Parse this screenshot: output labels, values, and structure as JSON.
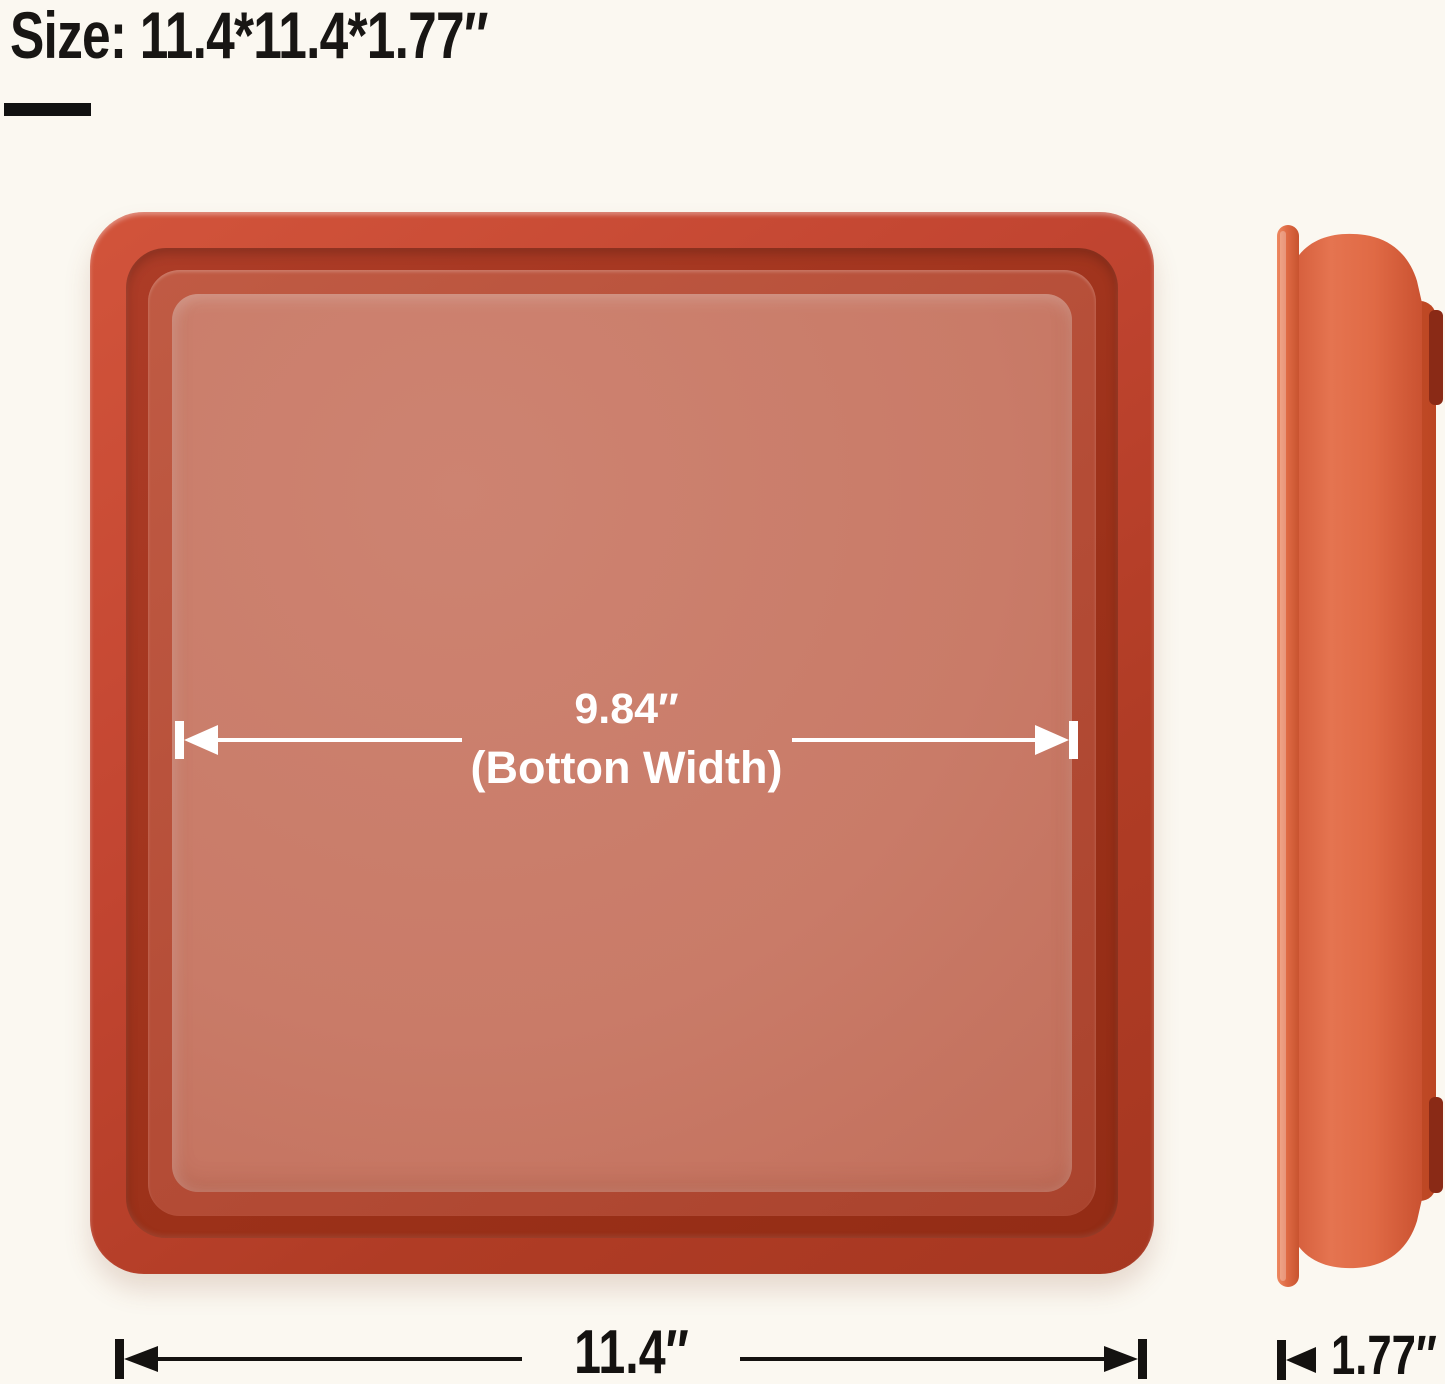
{
  "title": {
    "text": "Size: 11.4*11.4*1.77″"
  },
  "top_view": {
    "inner_width_value": "9.84″",
    "inner_width_label": "(Botton Width)",
    "overall_width_value": "11.4″"
  },
  "side_view": {
    "thickness_value": "1.77″"
  },
  "colors": {
    "background": "#fbf8f1",
    "ink": "#141210",
    "rim_red": "#c24531",
    "groove_red": "#9c3119",
    "floor_red": "#c97b68",
    "side_orange": "#e06a47",
    "annotation_white": "#ffffff"
  }
}
